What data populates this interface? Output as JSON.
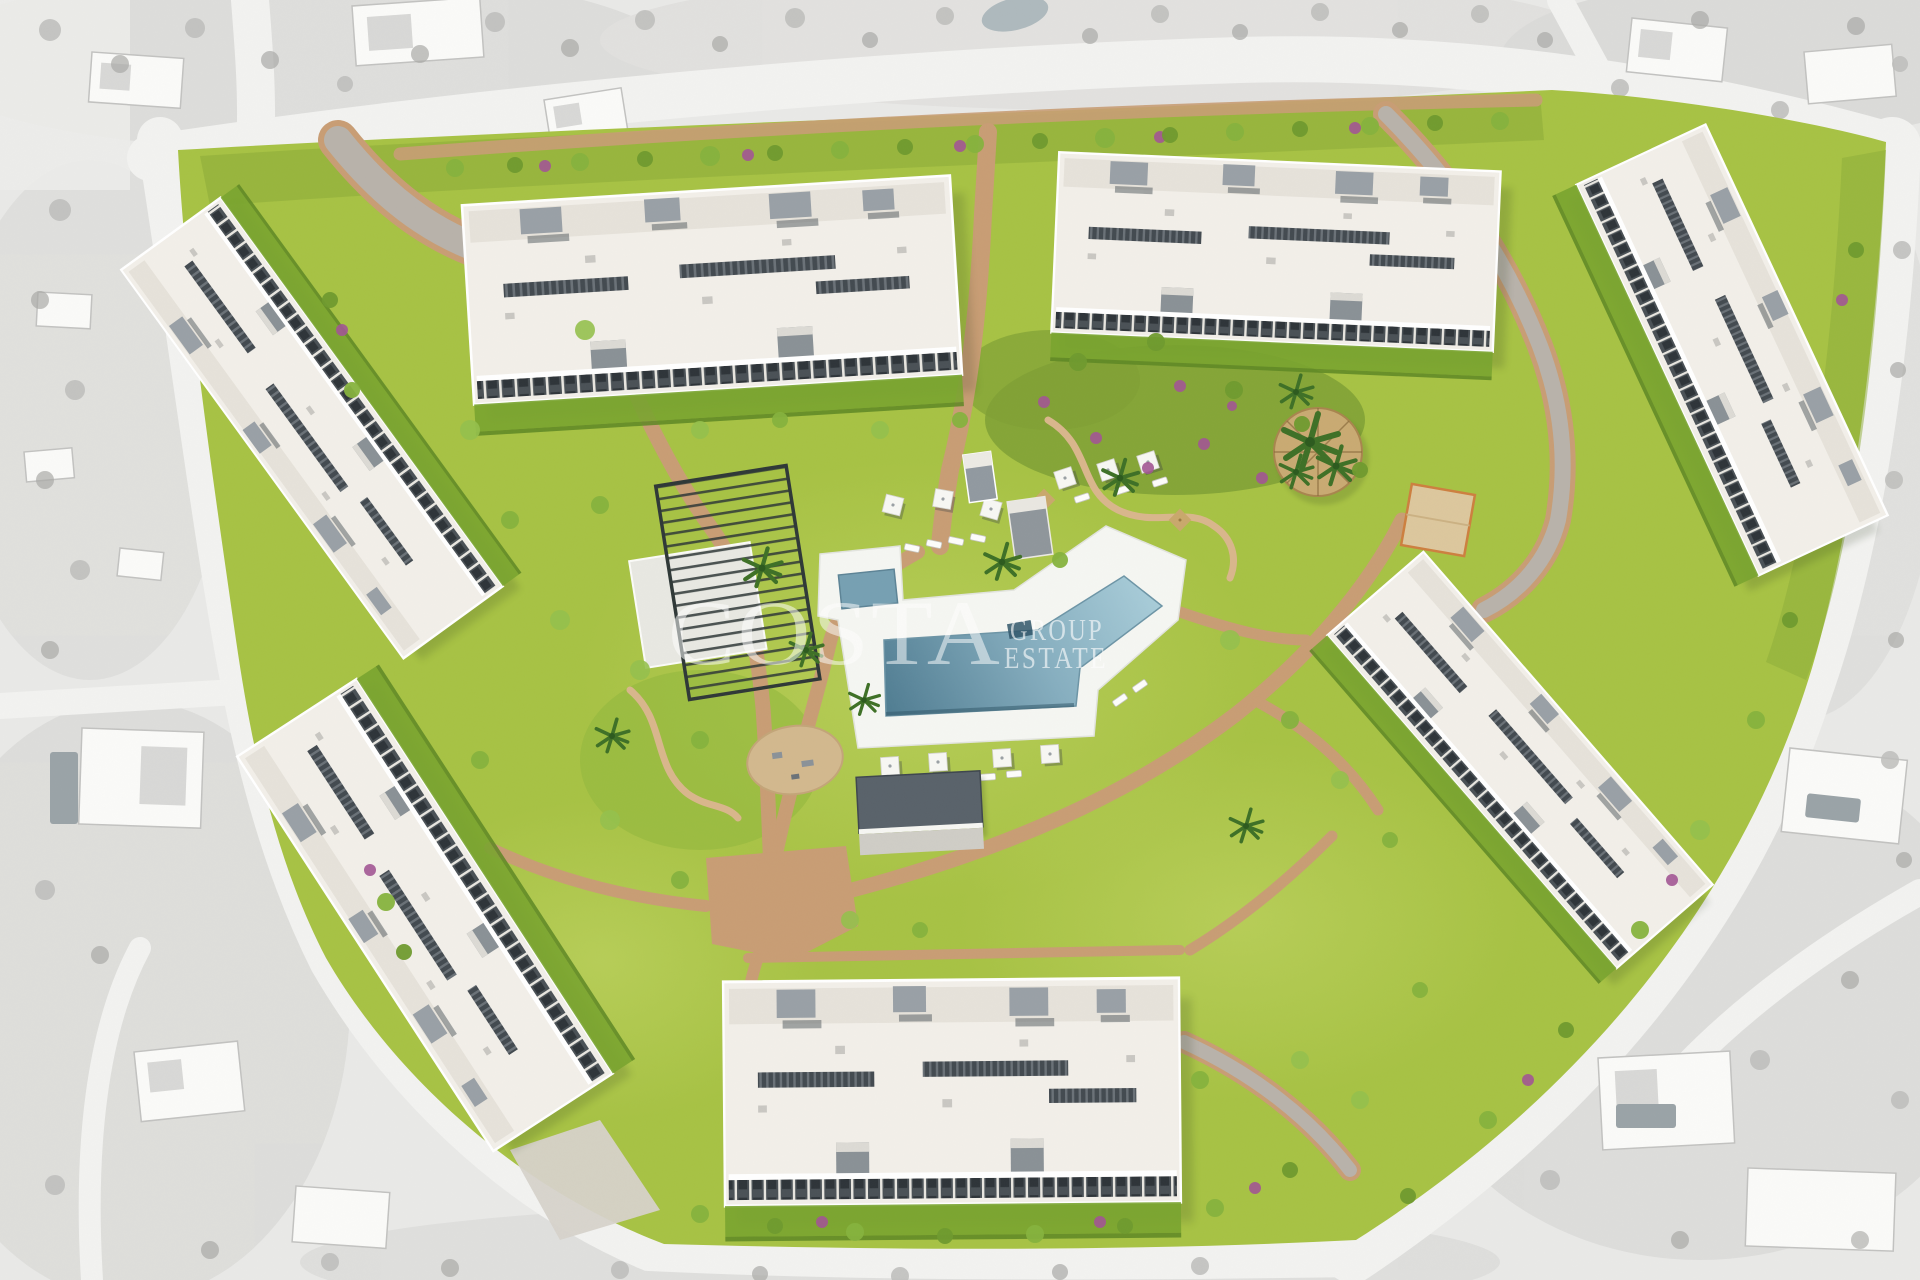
{
  "watermark": {
    "brand": "COSTA",
    "subline_top": "GROUP",
    "subline_bottom": "ESTATE"
  },
  "palette": {
    "surroundings_bg": "#e9e9e7",
    "surroundings_tree": "#bdbdbb",
    "road": "#f2f2f0",
    "site_grass": "#a7c244",
    "grass_dark": "#8cab38",
    "grass_light": "#c2d563",
    "garden_dark": "#7fa035",
    "path": "#c89d74",
    "path_light": "#d9b68c",
    "street": "#b8b2aa",
    "concrete": "#d8d4cc",
    "building_roof": "#f2efe9",
    "building_trim": "#ffffff",
    "building_dark": "#4a5156",
    "building_mid": "#99a0a6",
    "pool_deck": "#f5f6f2",
    "pool_dark": "#4f7c91",
    "pool_mid": "#86aebf",
    "pool_light": "#a9cdd9",
    "pergola": "#2f3837",
    "hedge": "#5d8723",
    "shrub_purple": "#a25594",
    "sand": "#d2b88e",
    "court": "#dcc79d",
    "court_edge": "#cd7f3f",
    "thatch": "#c9aa72",
    "watermark": "#ffffff"
  }
}
